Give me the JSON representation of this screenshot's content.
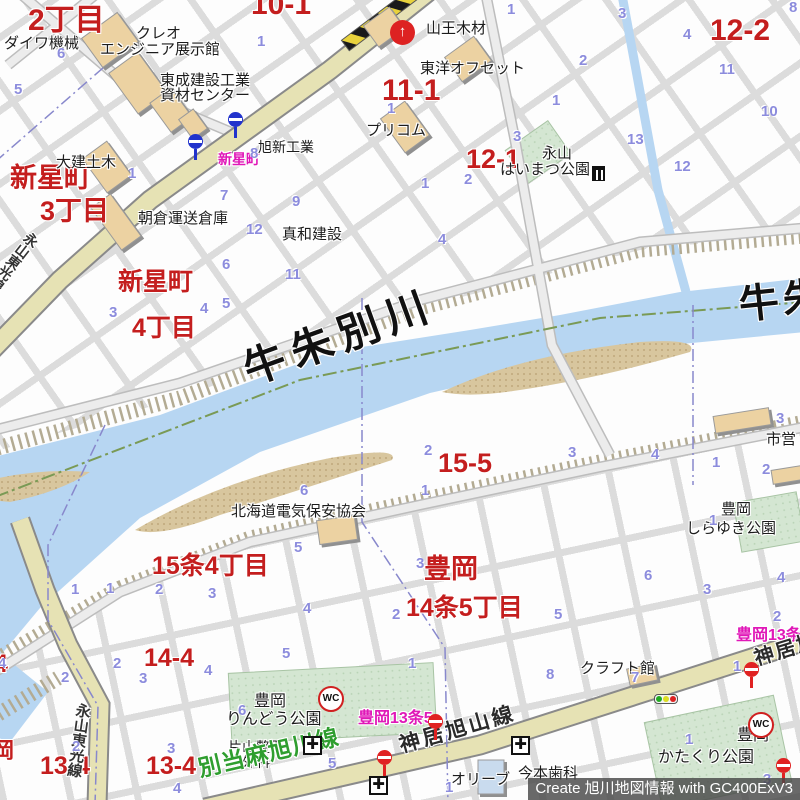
{
  "credit": "Create 旭川地図情報 with GC400ExV3",
  "colors": {
    "river": "#b7d6f2",
    "road_major": "#e6e2b4",
    "park": "#d4e6d2",
    "building": "#ecd2a2",
    "label_red": "#c41e1e",
    "label_magenta": "#e018b8",
    "lot_number_blue": "#8c8cdd",
    "road_green_label": "#2f9e2f",
    "bus_stop_blue": "#2233cc",
    "bus_stop_red": "#e02222"
  },
  "labels": {
    "red": [
      {
        "t": "2丁目",
        "x": 28,
        "y": 6,
        "s": 30
      },
      {
        "t": "10-1",
        "x": 251,
        "y": -10,
        "s": 30
      },
      {
        "t": "11-1",
        "x": 382,
        "y": 76,
        "s": 30
      },
      {
        "t": "12-1",
        "x": 466,
        "y": 146,
        "s": 27
      },
      {
        "t": "12-2",
        "x": 710,
        "y": 16,
        "s": 30
      },
      {
        "t": "新星町",
        "x": 10,
        "y": 165,
        "s": 27
      },
      {
        "t": "3丁目",
        "x": 40,
        "y": 198,
        "s": 27
      },
      {
        "t": "新星町",
        "x": 118,
        "y": 270,
        "s": 25
      },
      {
        "t": "4丁目",
        "x": 132,
        "y": 316,
        "s": 25
      },
      {
        "t": "15-5",
        "x": 438,
        "y": 450,
        "s": 27
      },
      {
        "t": "15条4丁目",
        "x": 152,
        "y": 554,
        "s": 25
      },
      {
        "t": "豊岡",
        "x": 424,
        "y": 556,
        "s": 27
      },
      {
        "t": "14条5丁目",
        "x": 406,
        "y": 596,
        "s": 25
      },
      {
        "t": "14-4",
        "x": 144,
        "y": 646,
        "s": 25
      },
      {
        "t": "13-4",
        "x": 40,
        "y": 754,
        "s": 25
      },
      {
        "t": "13-4",
        "x": 146,
        "y": 754,
        "s": 25
      },
      {
        "t": "4",
        "x": -6,
        "y": 652,
        "s": 25
      },
      {
        "t": "岡",
        "x": -8,
        "y": 740,
        "s": 22
      }
    ],
    "magenta": [
      {
        "t": "新星町",
        "x": 218,
        "y": 152,
        "s": 14
      },
      {
        "t": "豊岡13条5",
        "x": 358,
        "y": 711,
        "s": 16
      },
      {
        "t": "豊岡13条5",
        "x": 736,
        "y": 628,
        "s": 16
      }
    ],
    "black": [
      {
        "t": "ダイワ機械",
        "x": 4,
        "y": 36,
        "s": 15
      },
      {
        "t": "クレオ",
        "x": 136,
        "y": 26,
        "s": 15
      },
      {
        "t": "エンジニア展示館",
        "x": 100,
        "y": 42,
        "s": 15
      },
      {
        "t": "東成建設工業",
        "x": 160,
        "y": 73,
        "s": 15
      },
      {
        "t": "資材センター",
        "x": 160,
        "y": 88,
        "s": 15
      },
      {
        "t": "大建土木",
        "x": 56,
        "y": 155,
        "s": 15
      },
      {
        "t": "旭新工業",
        "x": 258,
        "y": 140,
        "s": 14
      },
      {
        "t": "朝倉運送倉庫",
        "x": 138,
        "y": 211,
        "s": 15
      },
      {
        "t": "真和建設",
        "x": 282,
        "y": 227,
        "s": 15
      },
      {
        "t": "山王木材",
        "x": 426,
        "y": 21,
        "s": 15
      },
      {
        "t": "東洋オフセット",
        "x": 420,
        "y": 61,
        "s": 15
      },
      {
        "t": "プリコム",
        "x": 366,
        "y": 123,
        "s": 15
      },
      {
        "t": "永山",
        "x": 542,
        "y": 146,
        "s": 15
      },
      {
        "t": "はいまつ公園",
        "x": 500,
        "y": 162,
        "s": 15
      },
      {
        "t": "北海道電気保安協会",
        "x": 231,
        "y": 504,
        "s": 15
      },
      {
        "t": "市営",
        "x": 766,
        "y": 432,
        "s": 15
      },
      {
        "t": "豊岡",
        "x": 721,
        "y": 502,
        "s": 15
      },
      {
        "t": "しらゆき公園",
        "x": 686,
        "y": 521,
        "s": 15
      },
      {
        "t": "豊岡",
        "x": 254,
        "y": 694,
        "s": 16
      },
      {
        "t": "りんどう公園",
        "x": 226,
        "y": 712,
        "s": 16
      },
      {
        "t": "クラフト館",
        "x": 580,
        "y": 661,
        "s": 15
      },
      {
        "t": "片山整形",
        "x": 228,
        "y": 740,
        "s": 14
      },
      {
        "t": "外科",
        "x": 242,
        "y": 755,
        "s": 14
      },
      {
        "t": "今本歯科",
        "x": 518,
        "y": 766,
        "s": 15
      },
      {
        "t": "オリーブ",
        "x": 451,
        "y": 772,
        "s": 15
      },
      {
        "t": "豊岡",
        "x": 737,
        "y": 728,
        "s": 16
      },
      {
        "t": "かたくり公園",
        "x": 658,
        "y": 750,
        "s": 16
      }
    ],
    "river": [
      {
        "t": "牛朱別川",
        "x": 238,
        "y": 352,
        "s": 42,
        "r": -20,
        "ls": 8
      },
      {
        "t": "牛朱",
        "x": 737,
        "y": 286,
        "s": 40,
        "r": -6,
        "ls": 4
      }
    ],
    "roads": [
      {
        "t": "神居旭山線",
        "x": 397,
        "y": 736,
        "s": 21,
        "r": -16,
        "c": "#2b2b2b",
        "ls": 3
      },
      {
        "t": "神居旭山線",
        "x": 752,
        "y": 650,
        "s": 20,
        "r": -17,
        "c": "#2b2b2b",
        "ls": 2
      },
      {
        "t": "別当麻旭川線",
        "x": 196,
        "y": 758,
        "s": 23,
        "r": -13,
        "c": "#2f9e2f",
        "ls": 1
      },
      {
        "t": "永山東光線",
        "x": 30,
        "y": 230,
        "s": 14,
        "v": 1,
        "r": 38,
        "c": "#333333"
      },
      {
        "t": "永山東光線",
        "x": 76,
        "y": 702,
        "s": 15,
        "v": 1,
        "r": 8,
        "c": "#333333"
      }
    ],
    "blue_numbers": [
      {
        "t": "6",
        "x": 57,
        "y": 46
      },
      {
        "t": "5",
        "x": 14,
        "y": 82
      },
      {
        "t": "1",
        "x": 257,
        "y": 34
      },
      {
        "t": "1",
        "x": 128,
        "y": 166
      },
      {
        "t": "8",
        "x": 250,
        "y": 146
      },
      {
        "t": "7",
        "x": 220,
        "y": 188
      },
      {
        "t": "9",
        "x": 292,
        "y": 194
      },
      {
        "t": "12",
        "x": 246,
        "y": 222
      },
      {
        "t": "1",
        "x": 507,
        "y": 2
      },
      {
        "t": "2",
        "x": 579,
        "y": 53
      },
      {
        "t": "1",
        "x": 552,
        "y": 93
      },
      {
        "t": "3",
        "x": 513,
        "y": 129
      },
      {
        "t": "1",
        "x": 387,
        "y": 101
      },
      {
        "t": "1",
        "x": 421,
        "y": 176
      },
      {
        "t": "2",
        "x": 464,
        "y": 172
      },
      {
        "t": "4",
        "x": 438,
        "y": 232
      },
      {
        "t": "3",
        "x": 618,
        "y": 6
      },
      {
        "t": "4",
        "x": 683,
        "y": 27
      },
      {
        "t": "8",
        "x": 789,
        "y": 0
      },
      {
        "t": "11",
        "x": 719,
        "y": 62
      },
      {
        "t": "10",
        "x": 761,
        "y": 104
      },
      {
        "t": "13",
        "x": 627,
        "y": 132
      },
      {
        "t": "12",
        "x": 674,
        "y": 159
      },
      {
        "t": "3",
        "x": 109,
        "y": 305
      },
      {
        "t": "4",
        "x": 200,
        "y": 301
      },
      {
        "t": "5",
        "x": 222,
        "y": 296
      },
      {
        "t": "6",
        "x": 222,
        "y": 257
      },
      {
        "t": "11",
        "x": 285,
        "y": 267
      },
      {
        "t": "2",
        "x": 424,
        "y": 443
      },
      {
        "t": "3",
        "x": 568,
        "y": 445
      },
      {
        "t": "1",
        "x": 421,
        "y": 483
      },
      {
        "t": "6",
        "x": 300,
        "y": 483
      },
      {
        "t": "4",
        "x": 651,
        "y": 447
      },
      {
        "t": "1",
        "x": 712,
        "y": 455
      },
      {
        "t": "2",
        "x": 762,
        "y": 462
      },
      {
        "t": "3",
        "x": 776,
        "y": 411
      },
      {
        "t": "1",
        "x": 709,
        "y": 513
      },
      {
        "t": "5",
        "x": 294,
        "y": 540
      },
      {
        "t": "3",
        "x": 416,
        "y": 556
      },
      {
        "t": "2",
        "x": 392,
        "y": 607
      },
      {
        "t": "3",
        "x": 208,
        "y": 586
      },
      {
        "t": "4",
        "x": 303,
        "y": 601
      },
      {
        "t": "1",
        "x": 71,
        "y": 582
      },
      {
        "t": "1",
        "x": 106,
        "y": 581
      },
      {
        "t": "2",
        "x": 155,
        "y": 582
      },
      {
        "t": "2",
        "x": 113,
        "y": 656
      },
      {
        "t": "2",
        "x": 61,
        "y": 670
      },
      {
        "t": "3",
        "x": 139,
        "y": 671
      },
      {
        "t": "4",
        "x": -2,
        "y": 656
      },
      {
        "t": "4",
        "x": 204,
        "y": 663
      },
      {
        "t": "5",
        "x": 282,
        "y": 646
      },
      {
        "t": "1",
        "x": 408,
        "y": 656
      },
      {
        "t": "6",
        "x": 238,
        "y": 703
      },
      {
        "t": "5",
        "x": 328,
        "y": 756
      },
      {
        "t": "1",
        "x": 445,
        "y": 780
      },
      {
        "t": "2",
        "x": 72,
        "y": 739
      },
      {
        "t": "3",
        "x": 167,
        "y": 741
      },
      {
        "t": "4",
        "x": 173,
        "y": 781
      },
      {
        "t": "5",
        "x": 554,
        "y": 607
      },
      {
        "t": "8",
        "x": 546,
        "y": 667
      },
      {
        "t": "7",
        "x": 631,
        "y": 670
      },
      {
        "t": "2",
        "x": 773,
        "y": 609
      },
      {
        "t": "1",
        "x": 733,
        "y": 659
      },
      {
        "t": "1",
        "x": 685,
        "y": 732
      },
      {
        "t": "3",
        "x": 763,
        "y": 772
      },
      {
        "t": "6",
        "x": 644,
        "y": 568
      },
      {
        "t": "3",
        "x": 703,
        "y": 582
      },
      {
        "t": "4",
        "x": 777,
        "y": 570
      }
    ]
  },
  "icons": [
    {
      "type": "bus-stop",
      "name": "bus-stop-icon",
      "x": 188,
      "y": 134,
      "color": "#2233cc"
    },
    {
      "type": "bus-stop",
      "name": "bus-stop-icon",
      "x": 228,
      "y": 112,
      "color": "#2233cc"
    },
    {
      "type": "bus-stop",
      "name": "bus-stop-icon",
      "x": 428,
      "y": 714,
      "color": "#e02222"
    },
    {
      "type": "bus-stop",
      "name": "bus-stop-icon",
      "x": 377,
      "y": 750,
      "color": "#e02222"
    },
    {
      "type": "bus-stop",
      "name": "bus-stop-icon",
      "x": 744,
      "y": 662,
      "color": "#e02222"
    },
    {
      "type": "bus-stop",
      "name": "bus-stop-icon",
      "x": 776,
      "y": 758,
      "color": "#e02222"
    },
    {
      "type": "wc",
      "name": "toilet-icon",
      "x": 318,
      "y": 686,
      "t": "WC"
    },
    {
      "type": "wc",
      "name": "toilet-icon",
      "x": 748,
      "y": 712,
      "t": "WC"
    },
    {
      "type": "hospital",
      "name": "hospital-cross-icon",
      "x": 303,
      "y": 736,
      "t": "✚"
    },
    {
      "type": "hospital",
      "name": "hospital-cross-icon",
      "x": 511,
      "y": 736,
      "t": "✚"
    },
    {
      "type": "hospital",
      "name": "hospital-cross-icon",
      "x": 369,
      "y": 776,
      "t": "✚"
    },
    {
      "type": "fire",
      "name": "red-circle-symbol-icon",
      "x": 390,
      "y": 20,
      "t": "↑"
    },
    {
      "type": "traffic",
      "name": "traffic-light-icon",
      "x": 654,
      "y": 694
    },
    {
      "type": "symbol",
      "name": "small-map-symbol-icon",
      "x": 592,
      "y": 166
    }
  ]
}
